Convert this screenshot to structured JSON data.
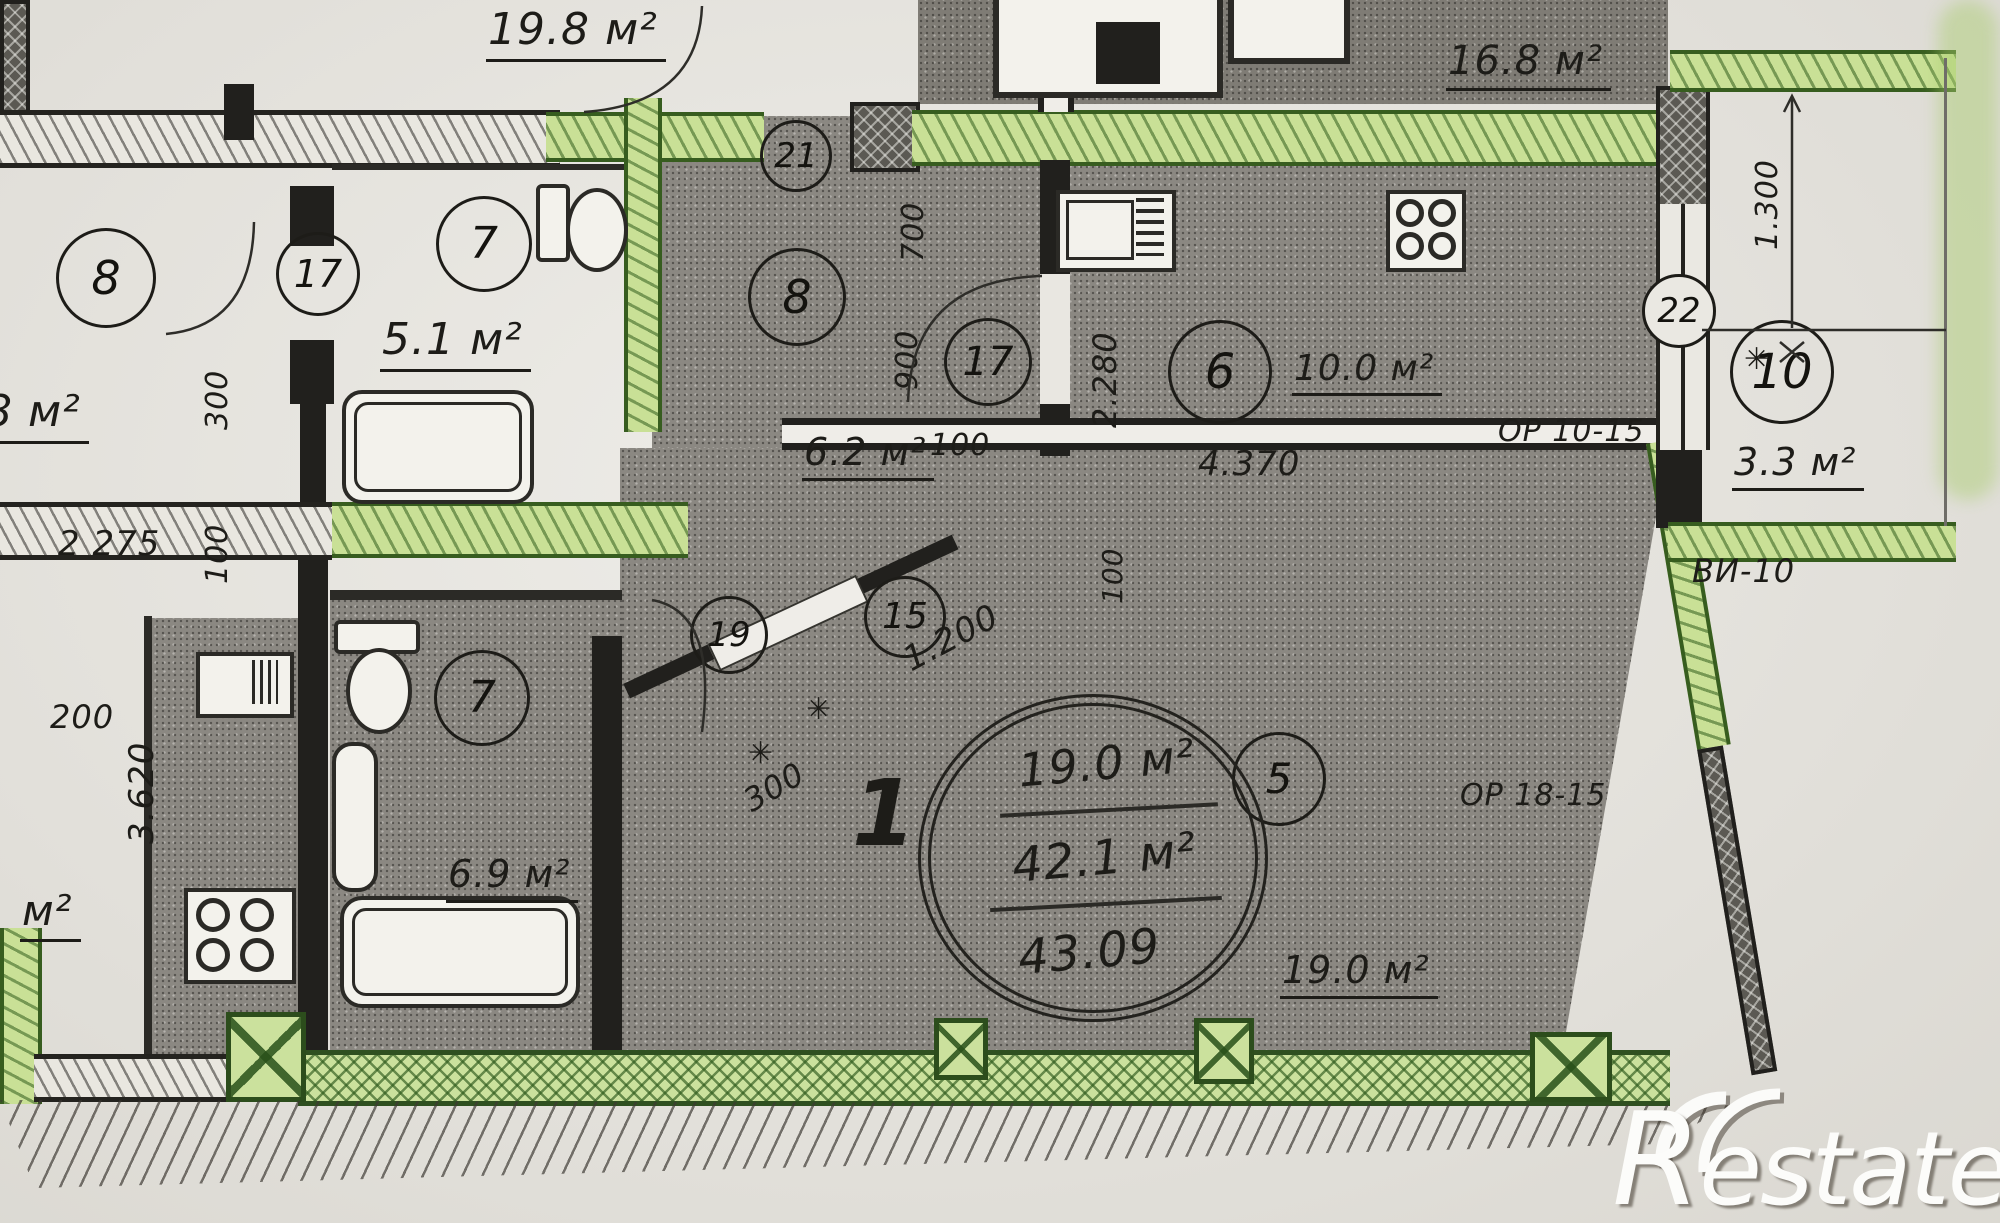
{
  "document": {
    "kind": "scanned apartment floor plan",
    "watermark": {
      "text": "Restate"
    }
  },
  "colors": {
    "paper": "#e9e7e1",
    "ink": "#21201d",
    "room_fill": "#8b8882",
    "highlight_green": "#c9e096",
    "highlight_green_line": "#375d1f",
    "watermark_white": "#fcfcfa"
  },
  "areas": [
    "19.8 м²",
    "16.8 м²",
    "8 м²",
    "5.1 м²",
    "6.2 м²",
    "10.0 м²",
    "3.3 м²",
    "6.9 м²",
    "19.0 м²",
    "м²"
  ],
  "room_numbers": [
    "8",
    "17",
    "7",
    "21",
    "8",
    "17",
    "6",
    "22",
    "10",
    "19",
    "15",
    "5",
    "7"
  ],
  "dimensions": [
    "1.300",
    "2.280",
    "700",
    "900",
    "100",
    "4.370",
    "2 275",
    "100",
    "300",
    "200",
    "3.620",
    "100",
    "1.200",
    "300"
  ],
  "window_marks": [
    "ОР 10-15",
    "ОР 18-15",
    "ВИ-10"
  ],
  "stamp": {
    "number": "1",
    "living_area": "19.0 м²",
    "total_area": "42.1 м²",
    "declared_area": "43.09"
  },
  "icons": {
    "star_tick": "✳"
  }
}
